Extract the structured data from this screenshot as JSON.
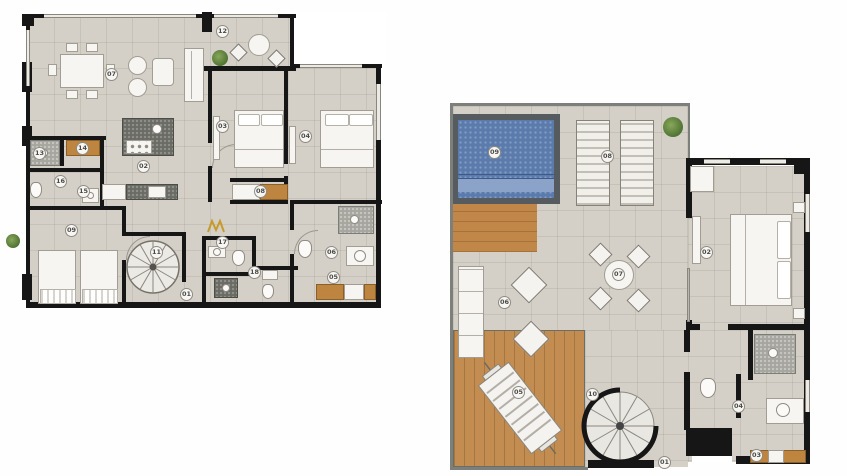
{
  "colors": {
    "floor_tile": "#d4d0c7",
    "wall": "#161616",
    "wood_deck": "#c38d52",
    "pool_water": "#5c7bad",
    "pool_shallow": "#8ba3c9",
    "plant_green": "#5d7d3e",
    "gold_logo": "#c79a2e",
    "fixture_white": "#f6f5f1",
    "counter_dark": "#6b6b65"
  },
  "plans": {
    "lower": {
      "labels": [
        "12",
        "07",
        "02",
        "03",
        "04",
        "08",
        "13",
        "14",
        "16",
        "15",
        "09",
        "11",
        "01",
        "17",
        "18",
        "06",
        "05"
      ]
    },
    "upper": {
      "labels": [
        "09",
        "08",
        "07",
        "06",
        "05",
        "10",
        "02",
        "04",
        "03",
        "01"
      ]
    }
  }
}
